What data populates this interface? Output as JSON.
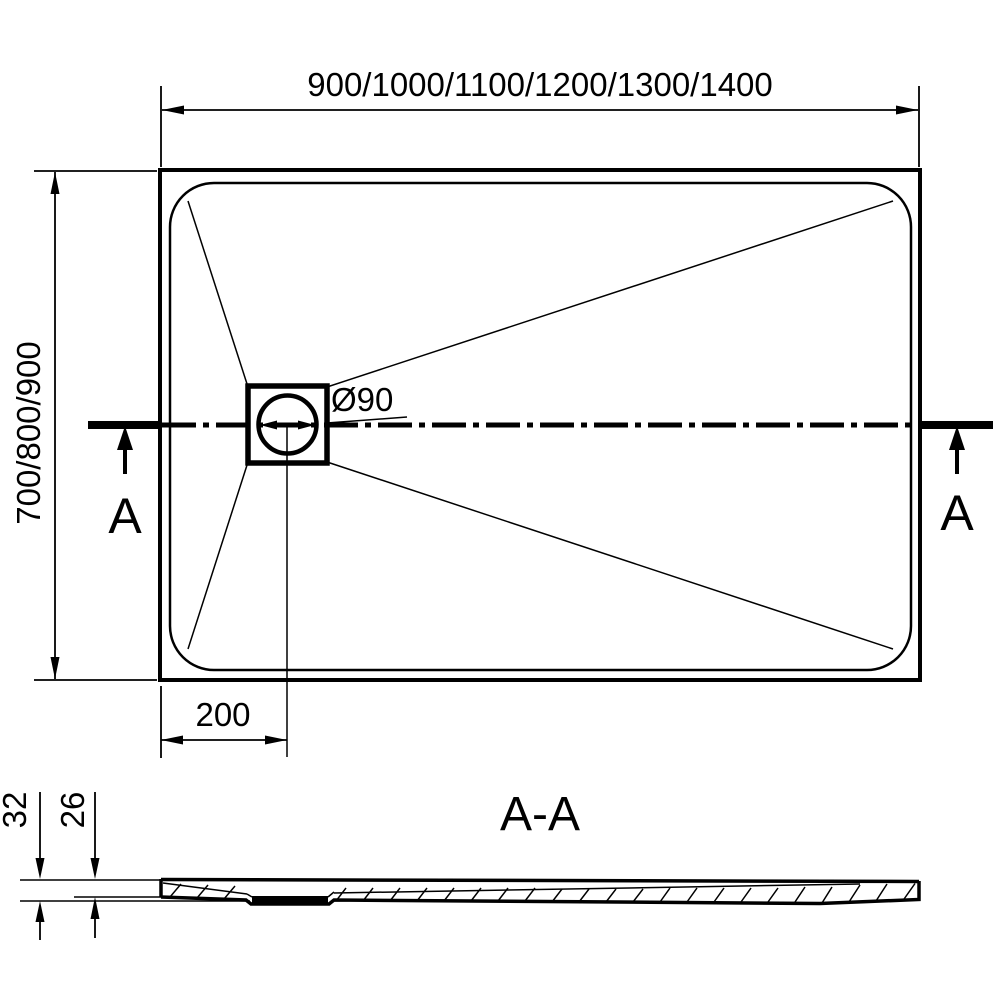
{
  "drawing": {
    "plan": {
      "width_dimension": "900/1000/1100/1200/1300/1400",
      "depth_dimension": "700/800/900",
      "drain_diameter_label": "Ø90",
      "drain_offset_dimension": "200",
      "section_marker_left": "A",
      "section_marker_right": "A"
    },
    "section": {
      "title": "A-A",
      "overall_height": "32",
      "inner_height": "26"
    },
    "colors": {
      "ink": "#000000",
      "paper": "#ffffff"
    }
  }
}
